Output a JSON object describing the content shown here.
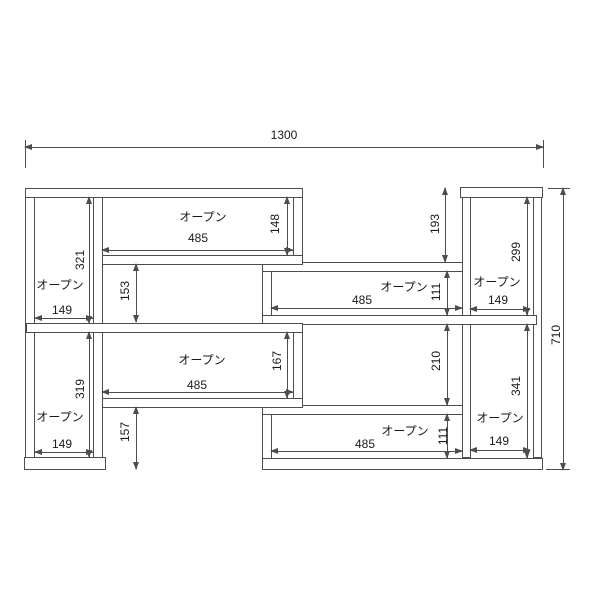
{
  "diagram": {
    "overall": {
      "width": "1300",
      "height": "710"
    },
    "compartments": {
      "top_shelf": {
        "label": "オープン",
        "width": "485",
        "height": "148"
      },
      "mid_shelf": {
        "label": "オープン",
        "width": "485",
        "height": "111"
      },
      "lower_shelf": {
        "label": "オープン",
        "width": "485",
        "height": "167"
      },
      "bottom_shelf": {
        "label": "オープン",
        "width": "485",
        "height": "111"
      },
      "left_top": {
        "label": "オープン",
        "width": "149",
        "height": "321"
      },
      "left_bottom": {
        "label": "オープン",
        "width": "149",
        "height": "319"
      },
      "right_top": {
        "label": "オープン",
        "width": "149",
        "height": "299"
      },
      "right_bottom": {
        "label": "オープン",
        "width": "149",
        "height": "341"
      }
    },
    "gaps": {
      "upper_left": "153",
      "lower_left": "157",
      "upper_right": "193",
      "mid_right": "210"
    },
    "colors": {
      "line": "#4d4d4d",
      "text": "#1a1a1a",
      "background": "#ffffff"
    }
  }
}
